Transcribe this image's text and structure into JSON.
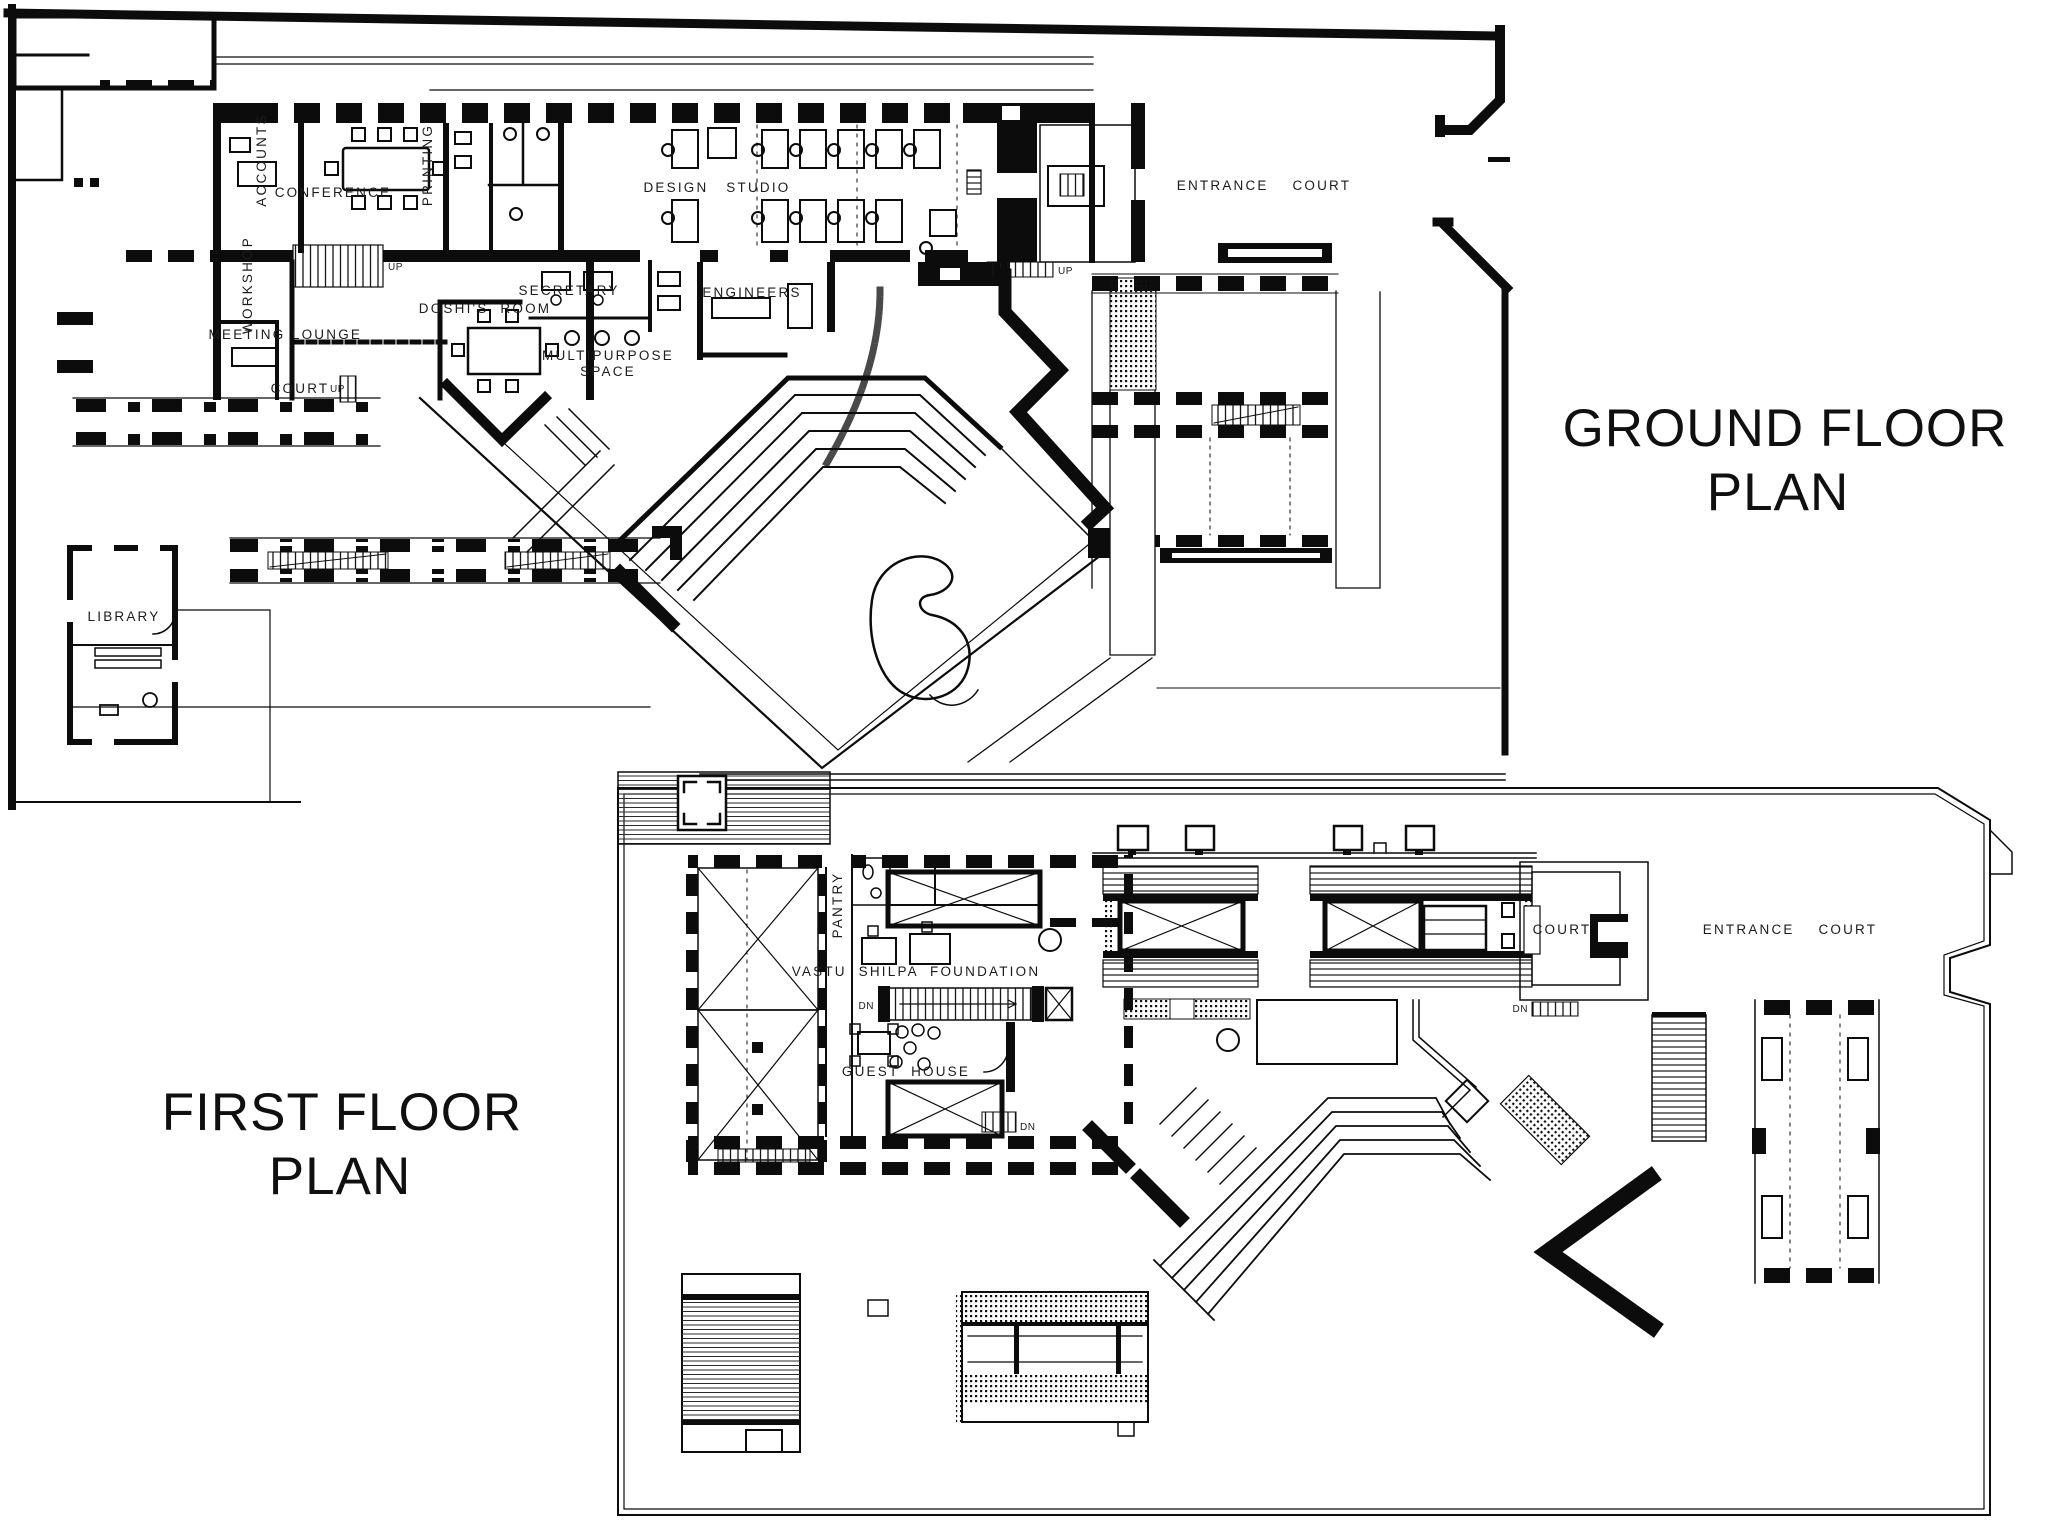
{
  "colors": {
    "paper": "#ffffff",
    "ink": "#0c0c0c",
    "label_ink": "#1c1c1c"
  },
  "titles": {
    "ground_line1": "GROUND FLOOR",
    "ground_line2": "PLAN",
    "first_line1": "FIRST FLOOR",
    "first_line2": "PLAN"
  },
  "ground_floor": {
    "labels": {
      "accounts": "ACCOUNTS",
      "conference": "CONFERENCE",
      "printing": "PRINTING",
      "design_studio": "DESIGN   STUDIO",
      "secretary": "SECRETARY",
      "engineers": "ENGINEERS",
      "doshis_room": "DOSHI'S  ROOM",
      "multipurpose_line1": "MULTIPURPOSE",
      "multipurpose_line2": "SPACE",
      "workshop": "WORKSHOP",
      "meeting": "MEETING",
      "lounge": "LOUNGE",
      "court": "COURT",
      "up_court": "UP",
      "up_lounge_stair": "UP",
      "up_entry": "UP",
      "library": "LIBRARY",
      "entrance_court": "ENTRANCE    COURT"
    }
  },
  "first_floor": {
    "labels": {
      "pantry": "PANTRY",
      "vastu_shilpa_foundation": "VASTU  SHILPA  FOUNDATION",
      "guest_house": "GUEST  HOUSE",
      "court": "COURT",
      "entrance_court": "ENTRANCE    COURT",
      "dn_main_stair": "DN",
      "dn_guest_stair": "DN",
      "dn_court_stair": "DN"
    }
  }
}
